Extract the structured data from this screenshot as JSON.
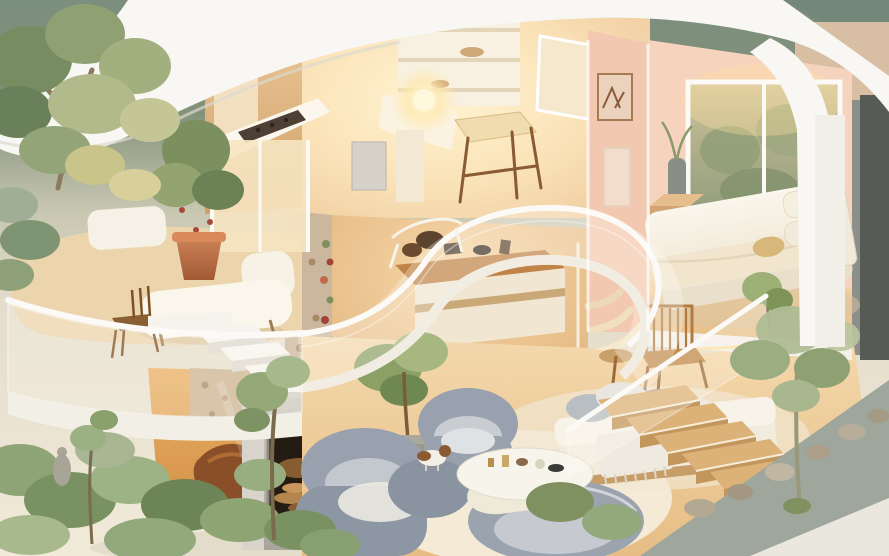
{
  "image": {
    "type": "3d-isometric-cutaway-render",
    "subject": "dollhouse-style two-story home interior with garden landscaping",
    "width_px": 889,
    "height_px": 556
  },
  "palette": {
    "bg_top": "#7c8e7e",
    "ground": "#f1ead9",
    "roof": "#f8f7f3",
    "roof_shadow": "#ddd9d0",
    "kitchen_glow": "#fff3d0",
    "kitchen_wall": "#f3d8b1",
    "wood": "#d9ab72",
    "wood_dark": "#6e4c2c",
    "peach": "#f2c9b0",
    "window_green": "#a8ab87",
    "bed_white": "#f7f2e7",
    "floor_wood": "#eecb97",
    "floor_orange": "#e0a058",
    "terrace_floor": "#ecd4ad",
    "terracotta": "#c0764c",
    "stone": "#cbb79d",
    "sofa_gray": "#98a1ad",
    "rug": "#f3ebd8",
    "fireplace": "#bbb7ae",
    "stove_glass": "#241b12",
    "stair_wood": "#d9ae74",
    "rail": "#fbfaf6",
    "glass": "rgba(255,252,244,0.25)",
    "green": "#8da273",
    "green_dark": "#6d8156",
    "green_light": "#b7c39c",
    "sage": "#9fae94",
    "slate": "#565b55",
    "concrete": "#9fa79d",
    "plinth": "#eae7df",
    "shimmer": "#d8bfa4",
    "glow": "#ffd98a",
    "dog_brown": "#8a5a32"
  },
  "scene": {
    "background": {
      "name": "sage-backdrop"
    },
    "rooms": [
      {
        "name": "kitchen-study",
        "objects": [
          "wall-cabinets",
          "range-hood",
          "cooktop-counter",
          "open-shelves",
          "pinboard",
          "glowing-lamp",
          "desk",
          "wooden-stool",
          "appliance"
        ]
      },
      {
        "name": "bedroom",
        "objects": [
          "double-bed",
          "pillows",
          "headboard",
          "nightstand",
          "window-garden-view",
          "framed-art",
          "floor-vase",
          "bedside-plant"
        ]
      },
      {
        "name": "terrace",
        "objects": [
          "chaise-lounge",
          "potted-plant",
          "wooden-chair",
          "glass-balustrade",
          "sliding-glass-door",
          "built-in-bench"
        ]
      },
      {
        "name": "mezzanine",
        "objects": [
          "curved-glass-railing",
          "white-handrail",
          "floor-edge-band"
        ]
      },
      {
        "name": "media-nook",
        "objects": [
          "sideboard",
          "decor-objects",
          "stone-pillar-with-vine",
          "spiral-stair"
        ]
      },
      {
        "name": "garden-room",
        "objects": [
          "stone-wall",
          "curved-lounge-chair",
          "glass-corner",
          "white-floating-stairs",
          "wood-stove"
        ]
      },
      {
        "name": "living-room",
        "objects": [
          "gray-armchair",
          "gray-sofa-group",
          "oval-coffee-table",
          "round-rug",
          "potted-tree",
          "daybed",
          "throw-pillows",
          "slat-chair",
          "side-table",
          "puppy",
          "led-strip"
        ]
      },
      {
        "name": "stair-garden",
        "objects": [
          "wooden-staircase",
          "glass-stair-railing",
          "planter-tree",
          "rocks",
          "concrete-planter-wall",
          "white-plinth"
        ]
      }
    ],
    "exterior": {
      "name": "landscaping",
      "objects": [
        "large-tree",
        "golden-shrubs",
        "small-trees",
        "garden-statue",
        "curved-white-roof",
        "arched-roof-band",
        "shimmer-wall",
        "slate-panel"
      ]
    }
  }
}
